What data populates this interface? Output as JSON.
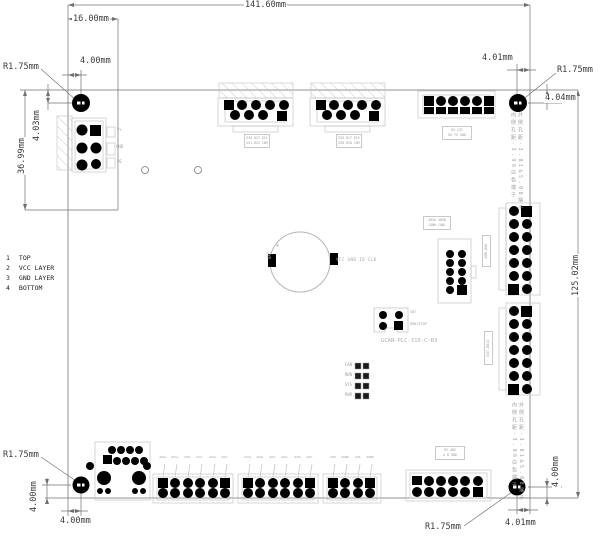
{
  "drawing": {
    "board_name": "GCAN-PLC-310-C-B3",
    "colors": {
      "line": "#909090",
      "dim": "#707070",
      "dim_text": "#3a3a3a",
      "silkscreen": "#9f9f9f",
      "pad": "#000000",
      "background": "#ffffff"
    },
    "dimensions": {
      "total_width": "141.60mm",
      "left_inset": "16.00mm",
      "hole_radius_tl": "R1.75mm",
      "hole_offset_x_tl": "4.00mm",
      "hole_offset_y_tl": "4.03mm",
      "left_section_height": "36.99mm",
      "hole_offset_x_tr": "4.01mm",
      "hole_radius_tr": "R1.75mm",
      "hole_offset_y_tr": "4.04mm",
      "total_height": "125.02mm",
      "hole_offset_y_br": "4.00mm",
      "hole_offset_x_br": "4.01mm",
      "hole_radius_br": "R1.75mm",
      "hole_radius_bl": "R1.75mm",
      "hole_offset_y_bl": "4.00mm",
      "hole_offset_x_bl": "4.00mm"
    },
    "legend": {
      "rows": [
        {
          "num": "1",
          "label": "TOP"
        },
        {
          "num": "2",
          "label": "VCC LAYER"
        },
        {
          "num": "3",
          "label": "GND LAYER"
        },
        {
          "num": "4",
          "label": "BOTTOM"
        }
      ]
    },
    "silkscreen": {
      "battery_label": "BAT",
      "battery_polarity": "+",
      "rtc_pins": "VCC GND IO CLK",
      "power_pins": [
        "V+",
        "GND",
        "PE"
      ],
      "jumper_pin": "INT",
      "jumper_label": "RUN/STOP",
      "led_labels": [
        "CAN",
        "RUN",
        "SYS",
        "PWR"
      ],
      "header_blocks": {
        "di1": {
          "row1": "DI0 DI2 DI4",
          "row2": "DI1 DI3 COM"
        },
        "di2": {
          "row1": "DI5 DI7 DI9",
          "row2": "DI6 DI8 COM"
        },
        "rs232": {
          "row1": "RS-232",
          "row2": "RX TX GND"
        },
        "comm": {
          "row1": "485A 485B",
          "row2": "CANH CANL"
        },
        "rs485": {
          "row1": "RS-485",
          "row2": "A B GND"
        },
        "do1": "DO0-DO6",
        "do2": "DO7-DO13"
      },
      "terminal_pins": {
        "block1": [
          "AI0+",
          "AI1+",
          "AI0-",
          "AI1-",
          "AI2+",
          "AI2-"
        ],
        "block2": [
          "AI3+",
          "AI4+",
          "AI3-",
          "AI4-",
          "AI5+",
          "AI5-"
        ],
        "block3": [
          "AO0",
          "AGND",
          "AO1",
          "AGND"
        ]
      },
      "notes_vertical": {
        "inner": "内侧孔距-3.96白色端子",
        "outer": "外侧孔距-3.81&5.08端子"
      }
    }
  }
}
